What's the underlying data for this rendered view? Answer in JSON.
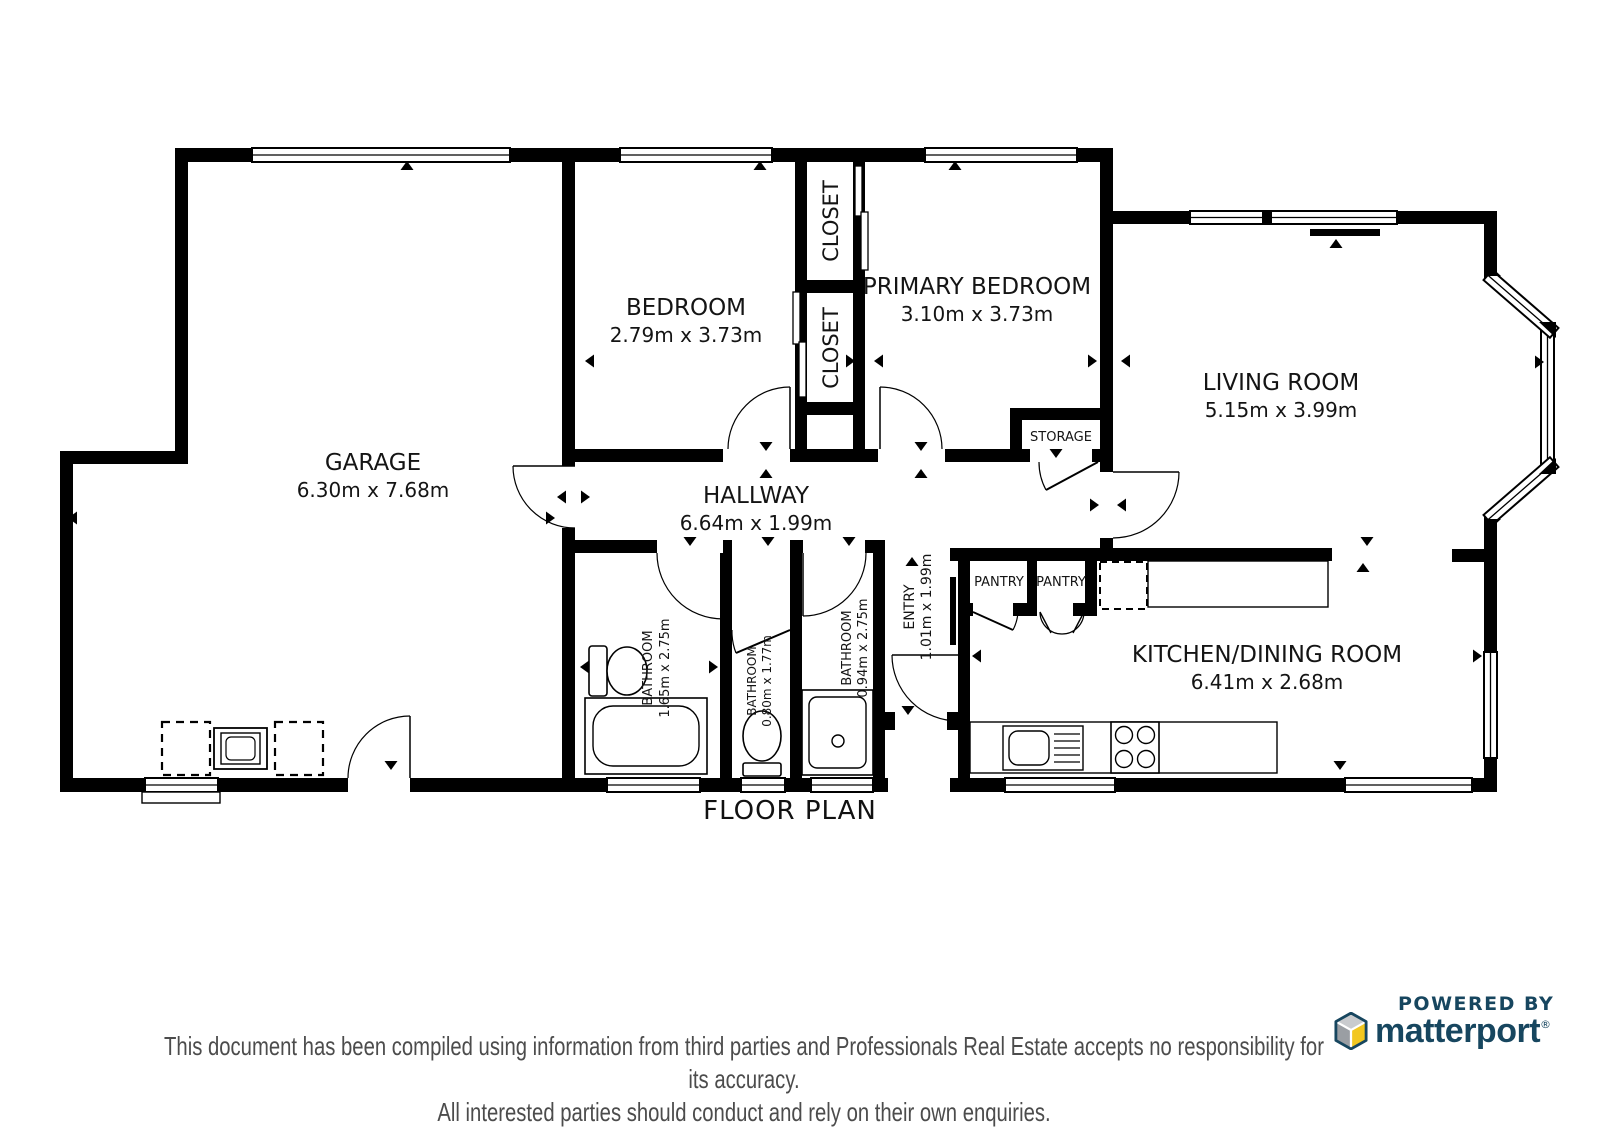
{
  "title": "FLOOR PLAN",
  "rooms": {
    "garage": {
      "name": "GARAGE",
      "dims": "6.30m x 7.68m"
    },
    "bedroom": {
      "name": "BEDROOM",
      "dims": "2.79m x 3.73m"
    },
    "primary_bedroom": {
      "name": "PRIMARY BEDROOM",
      "dims": "3.10m x 3.73m"
    },
    "living_room": {
      "name": "LIVING ROOM",
      "dims": "5.15m x 3.99m"
    },
    "hallway": {
      "name": "HALLWAY",
      "dims": "6.64m x 1.99m"
    },
    "kitchen_dining": {
      "name": "KITCHEN/DINING ROOM",
      "dims": "6.41m x 2.68m"
    },
    "bathroom_1": {
      "name": "BATHROOM",
      "dims": "1.65m x 2.75m"
    },
    "bathroom_2": {
      "name": "BATHROOM",
      "dims": "0.80m x 1.77m"
    },
    "bathroom_3": {
      "name": "BATHROOM",
      "dims": "0.94m x 2.75m"
    },
    "entry": {
      "name": "ENTRY",
      "dims": "1.01m x 1.99m"
    },
    "closet_top": {
      "name": "CLOSET"
    },
    "closet_bottom": {
      "name": "CLOSET"
    },
    "storage": {
      "name": "STORAGE"
    },
    "pantry_left": {
      "name": "PANTRY"
    },
    "pantry_right": {
      "name": "PANTRY"
    }
  },
  "branding": {
    "powered_by": "POWERED BY",
    "brand": "matterport",
    "reg": "®",
    "navy": "#17465F",
    "yellow": "#F2C720",
    "gray_light": "#C9CBCE",
    "gray_dark": "#9A9EA3"
  },
  "disclaimer": {
    "line1": "This document has been compiled using information from third parties and Professionals Real Estate accepts no responsibility for its accuracy.",
    "line2": "All interested parties should conduct and rely on their own enquiries."
  },
  "colors": {
    "wall": "#000000",
    "text": "#141414",
    "disclaimer": "#4C4C4C"
  }
}
